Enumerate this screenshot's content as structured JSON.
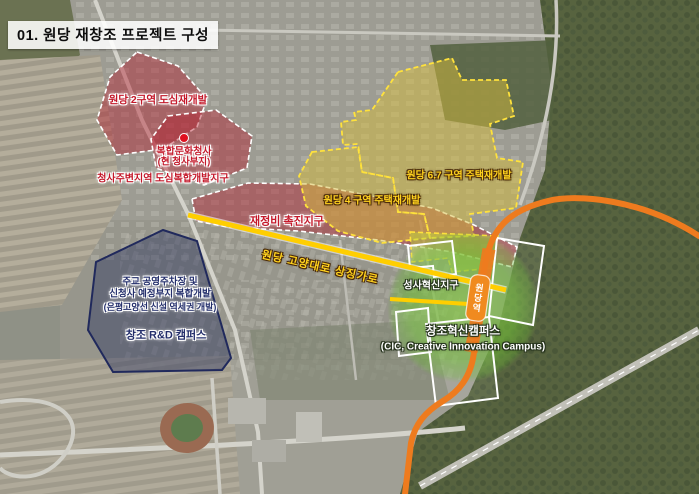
{
  "page": {
    "title": "01. 원당 재창조 프로젝트 구성"
  },
  "zones": {
    "red": {
      "color": "#c4182a",
      "zone2_label": "원당 2구역 도심재개발",
      "complex_label_line1": "복합문화청사",
      "complex_label_line2": "(현 청사부지)",
      "surround_label": "청사주변지역 도심복합개발지구",
      "promotion_label": "재정비 촉진지구"
    },
    "yellow": {
      "color": "#ffd21e",
      "zone67_label": "원당 6.7 구역 주택재개발",
      "zone4_label": "원당 4 구역 주택재개발"
    },
    "blue": {
      "color": "#232e6b",
      "parking_label_line1": "주교 공영주차장 및",
      "parking_label_line2": "신청사 예정부지 복합개발",
      "parking_label_line3": "(은평고양선 신설 역세권 개발)",
      "campus_label": "창조 R&D 캠퍼스"
    },
    "green": {
      "color": "#6dbb3c",
      "seongsa_label": "성사혁신지구",
      "cic_label_line1": "창조혁신캠퍼스",
      "cic_label_line2": "(CIC, Creative Innovation Campus)"
    }
  },
  "roads": {
    "symbol_street_label": "원당 고양대로 상징가로",
    "symbol_street_color": "#ffce00",
    "rail_color": "#ee7b1e",
    "station_label": "원당역"
  }
}
